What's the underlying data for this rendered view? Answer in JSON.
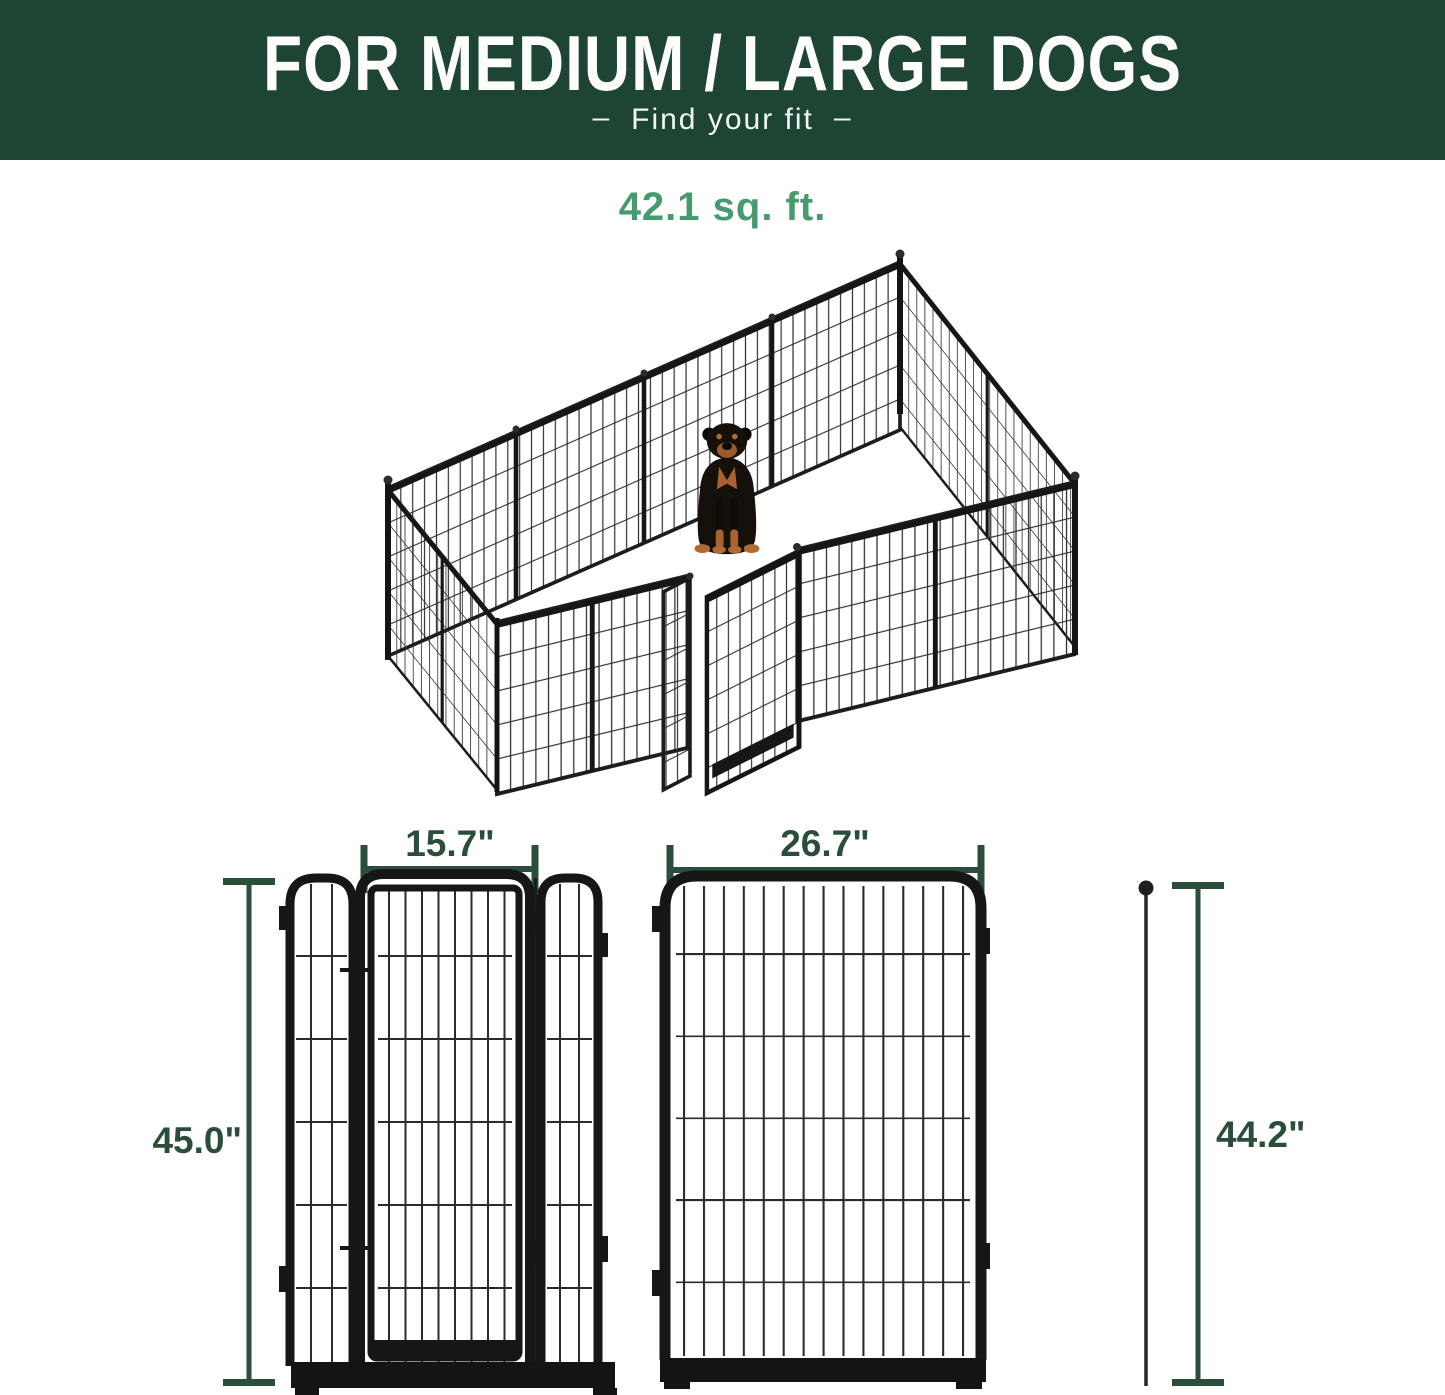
{
  "header": {
    "title": "FOR MEDIUM / LARGE DOGS",
    "dash": "–",
    "subtitle": "Find your fit"
  },
  "area": {
    "label": "42.1 sq. ft."
  },
  "dimensions": {
    "door_section_width": "15.7\"",
    "panel_width": "26.7\"",
    "door_section_height": "45.0\"",
    "panel_height": "44.2\""
  },
  "colors": {
    "banner_green": "#1e4434",
    "accent_green": "#459b6d",
    "dimension_green": "#2b4e3b",
    "panel_black": "#161616"
  }
}
